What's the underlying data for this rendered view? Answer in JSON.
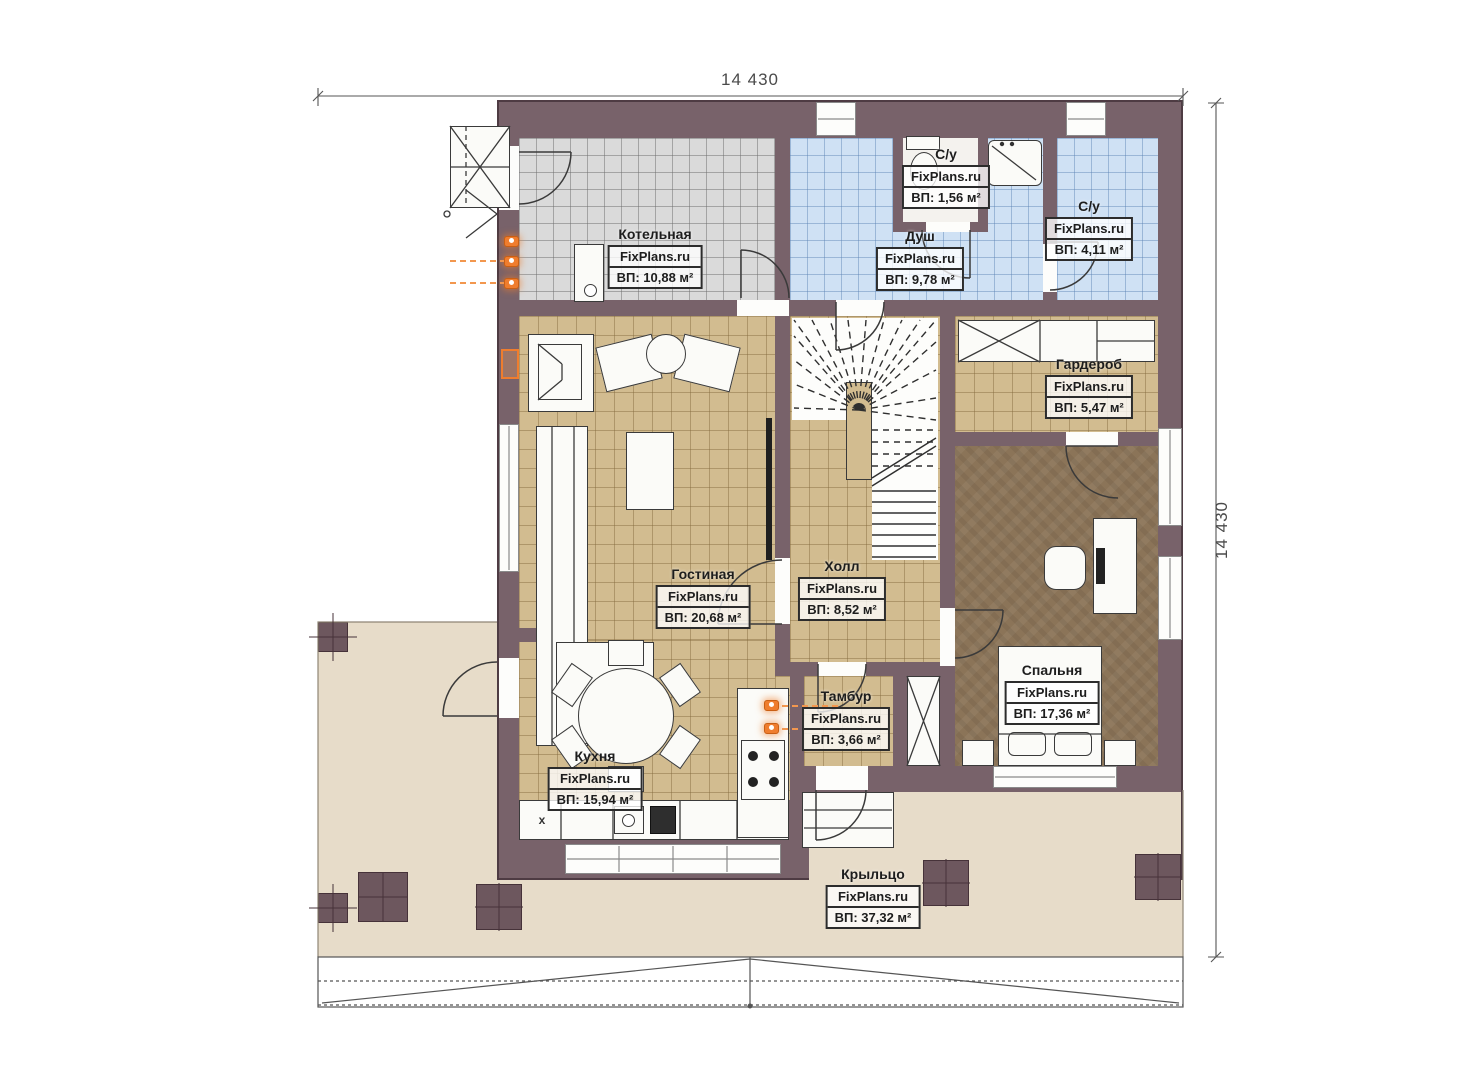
{
  "dims": {
    "top": "14 430",
    "right": "14 430"
  },
  "watermark": "FixPlans.ru",
  "rooms": [
    {
      "id": "boiler",
      "name": "Котельная",
      "area": "ВП: 10,88 м²"
    },
    {
      "id": "wc-small",
      "name": "С/у",
      "area": "ВП: 1,56 м²"
    },
    {
      "id": "shower",
      "name": "Душ",
      "area": "ВП: 9,78 м²"
    },
    {
      "id": "wc",
      "name": "С/у",
      "area": "ВП: 4,11 м²"
    },
    {
      "id": "wardrobe",
      "name": "Гардероб",
      "area": "ВП: 5,47 м²"
    },
    {
      "id": "living",
      "name": "Гостиная",
      "area": "ВП: 20,68 м²"
    },
    {
      "id": "hall",
      "name": "Холл",
      "area": "ВП: 8,52 м²"
    },
    {
      "id": "bedroom",
      "name": "Спальня",
      "area": "ВП: 17,36 м²"
    },
    {
      "id": "vestibule",
      "name": "Тамбур",
      "area": "ВП: 3,66 м²"
    },
    {
      "id": "kitchen",
      "name": "Кухня",
      "area": "ВП: 15,94 м²"
    },
    {
      "id": "porch",
      "name": "Крыльцо",
      "area": "ВП: 37,32 м²"
    }
  ],
  "markers": {
    "cabinet_x": "x"
  },
  "colors": {
    "wall": "#78626a",
    "floor_tile_tan": "#d2bc90",
    "floor_tile_gray": "#dadada",
    "floor_tile_blue": "#cfe1f4",
    "floor_bedroom": "#8b7458",
    "porch": "#e7dcc9",
    "accent_orange": "#ef7d2e"
  }
}
